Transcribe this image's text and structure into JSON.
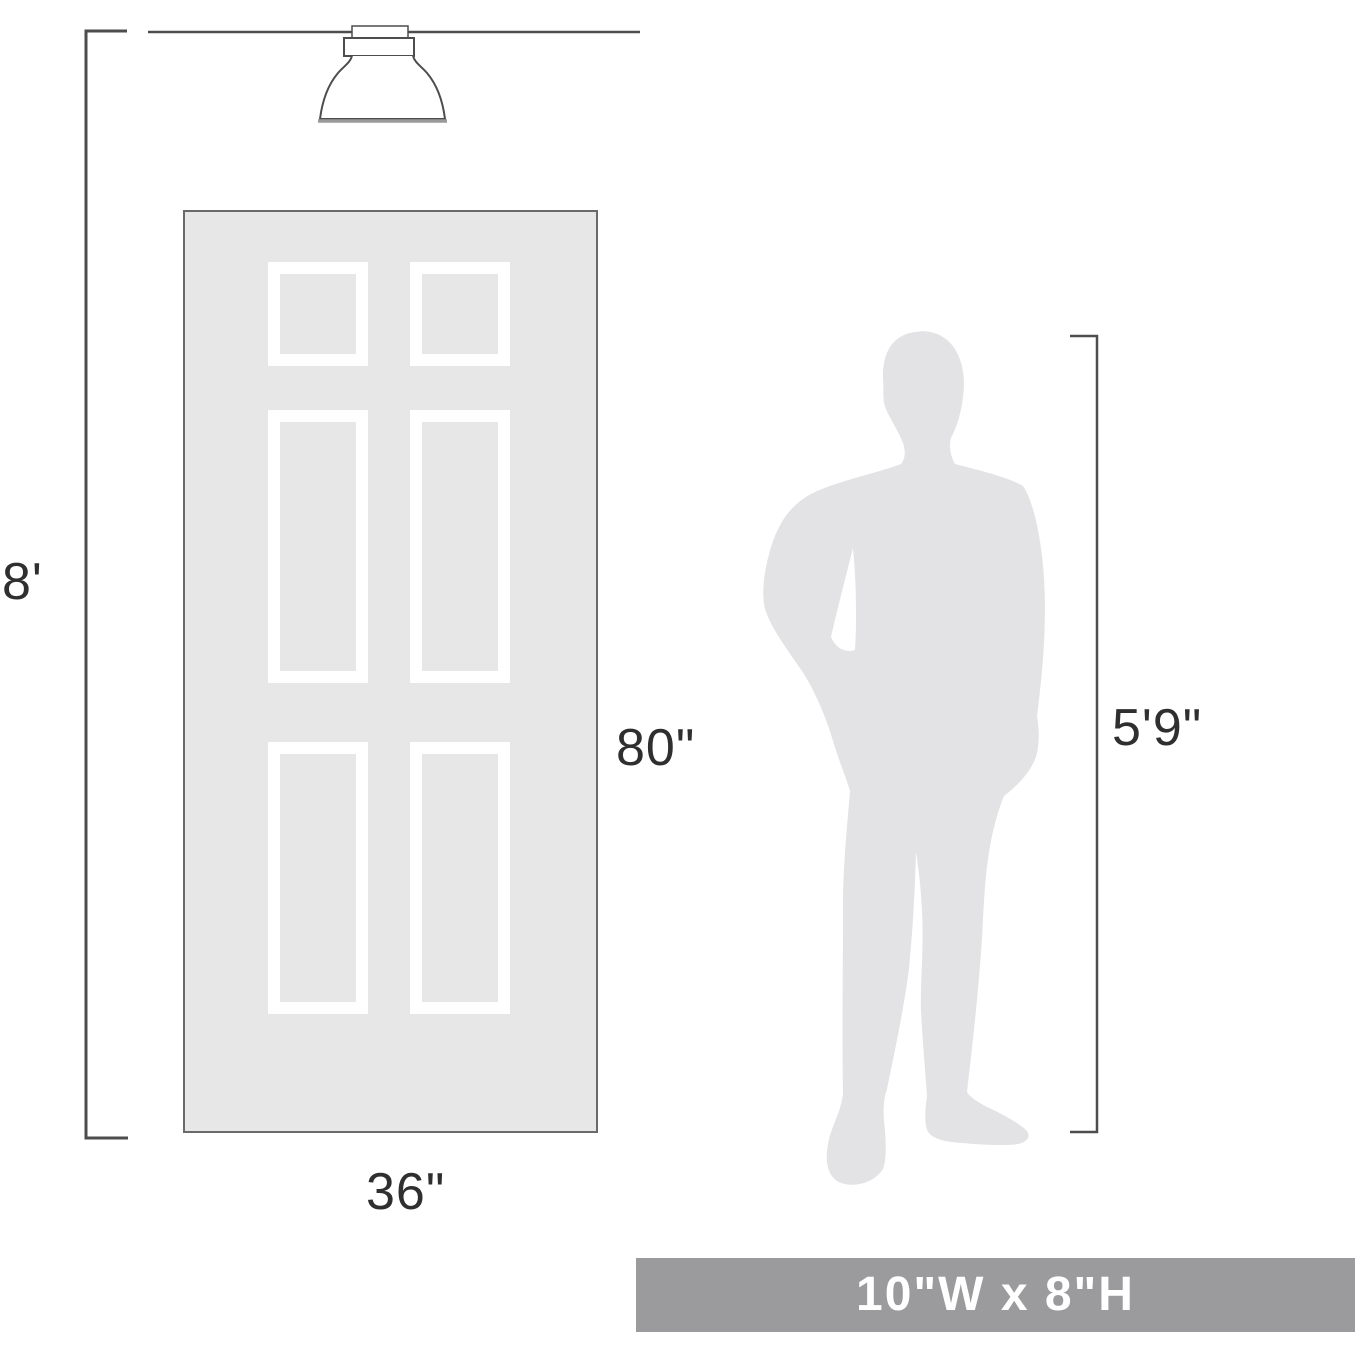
{
  "page": {
    "type": "product-scale-diagram",
    "background": "#ffffff"
  },
  "dimensions": {
    "ceiling_height_label": "8'",
    "door_height_label": "80\"",
    "door_width_label": "36\"",
    "person_height_label": "5'9\""
  },
  "banner": {
    "text": "10\"W x 8\"H",
    "background": "#9b9b9d",
    "text_color": "#ffffff"
  },
  "illustrations": {
    "fixture": "flush-mount-ceiling-light",
    "door": "six-panel-door",
    "person": "man-silhouette"
  },
  "colors": {
    "line": "#4d4d4d",
    "label_text": "#2f2f2f",
    "door_fill": "#e7e7e7",
    "door_border": "#6a6a6a",
    "panel_frame": "#ffffff",
    "silhouette_fill": "#e3e3e5",
    "shade_rim": "#9a9a9a"
  }
}
